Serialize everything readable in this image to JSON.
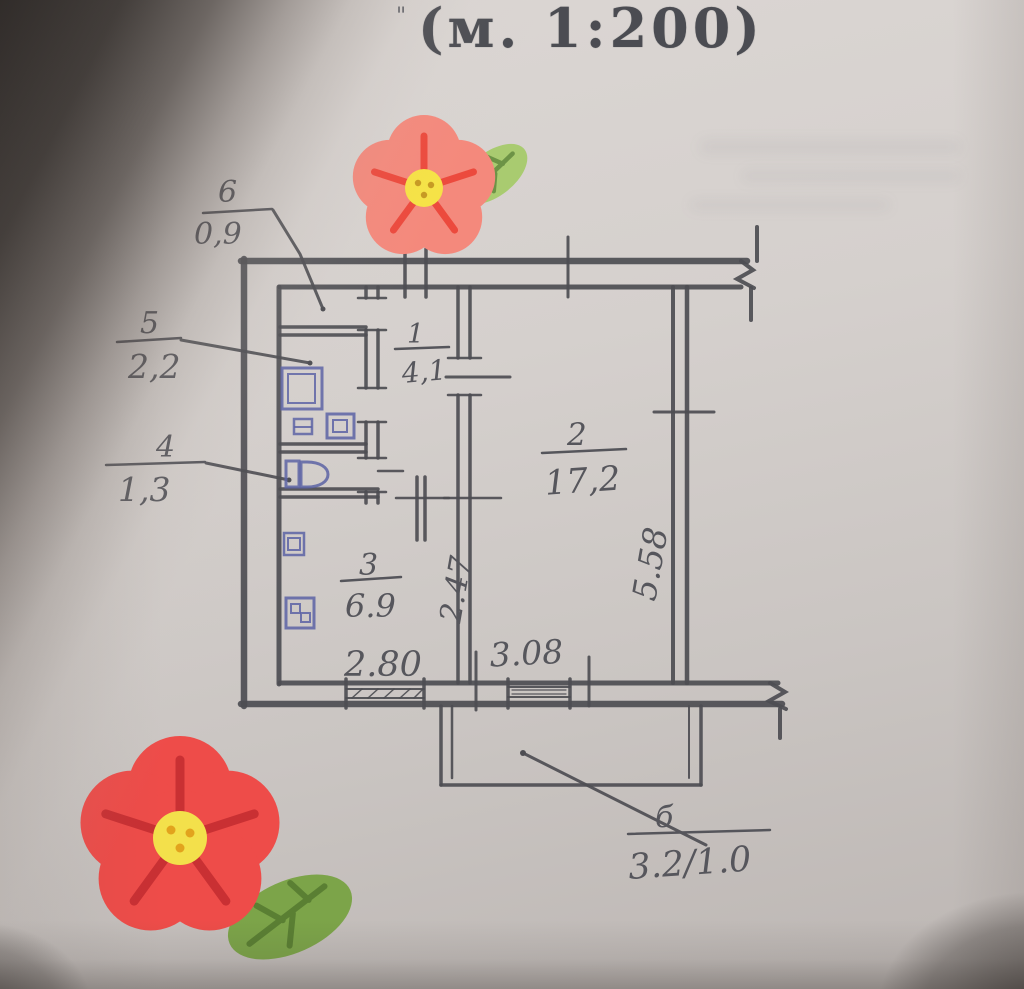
{
  "photo": {
    "scale_caption": "(м. 1:200)",
    "corner_mark": "\""
  },
  "plan": {
    "callouts": [
      {
        "number": "6",
        "area": "0,9"
      },
      {
        "number": "5",
        "area": "2,2"
      },
      {
        "number": "4",
        "area": "1,3"
      }
    ],
    "rooms": [
      {
        "number": "1",
        "area": "4,1"
      },
      {
        "number": "2",
        "area": "17,2"
      },
      {
        "number": "3",
        "area": "6.9"
      }
    ],
    "dimensions": {
      "bottom_left_width": "2.80",
      "bottom_right_width": "3.08",
      "inner_depth": "2.47",
      "right_depth": "5.58"
    },
    "balcony": {
      "label": "б",
      "area": "3.2/1.0"
    }
  },
  "colors": {
    "pencil": "#4d4d52",
    "ink_fixtures": "#5c63a4",
    "paper": "#d3cecb",
    "flower_top_petal": "#f4897c",
    "flower_top_vein": "#ec4a3d",
    "flower_bottom_petal": "#ee4c49",
    "flower_bottom_vein": "#c93033",
    "flower_center": "#f3e04b",
    "leaf_light": "#a9cb70",
    "leaf_dark": "#7ca449"
  }
}
